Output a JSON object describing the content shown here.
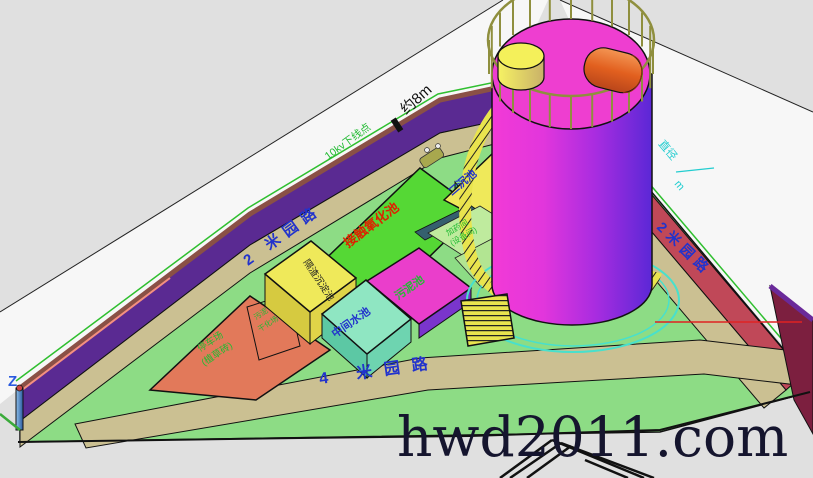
{
  "watermark": "hwd2011.com",
  "roads": {
    "left": "2 米园路",
    "bottom": "4 米园路",
    "right": "2米园路"
  },
  "annotations": {
    "approx_length": "约8m",
    "power_line": "10kv下线点",
    "diameter_label": "直径",
    "diameter_unit": "m",
    "ucs_z": "Z"
  },
  "facilities": {
    "secondary_sedimentation": "二沉池",
    "contact_oxidation": "接触氧化池",
    "grit_sedimentation": "隔渣沉淀池",
    "intermediate_pool": "中间水池",
    "sludge_pool": "污泥池",
    "equipment_room_line1": "加药间",
    "equipment_room_line2": "(设备间)",
    "parking_line1": "停车场",
    "parking_line2": "(植草砖)",
    "sludge_drying_line1": "污泥",
    "sludge_drying_line2": "干化场"
  },
  "colors": {
    "background": "#e0e0e0",
    "wall_purple": "#5a2a92",
    "road_tan": "#cbc092",
    "platform_green": "#8ddc85",
    "tank_magenta": "#ee3ed0",
    "tank_purple": "#5b28d6",
    "block_green": "#55d835",
    "block_yellow": "#efe95a",
    "block_aqua": "#8fe6c2",
    "block_magenta": "#ea3ecb",
    "salmon_area": "#e2795a",
    "crimson_wall": "#c04858",
    "label_blue": "#2233cc",
    "label_green": "#22bb33",
    "label_red": "#dd2200",
    "label_cyan": "#22cdd0"
  }
}
